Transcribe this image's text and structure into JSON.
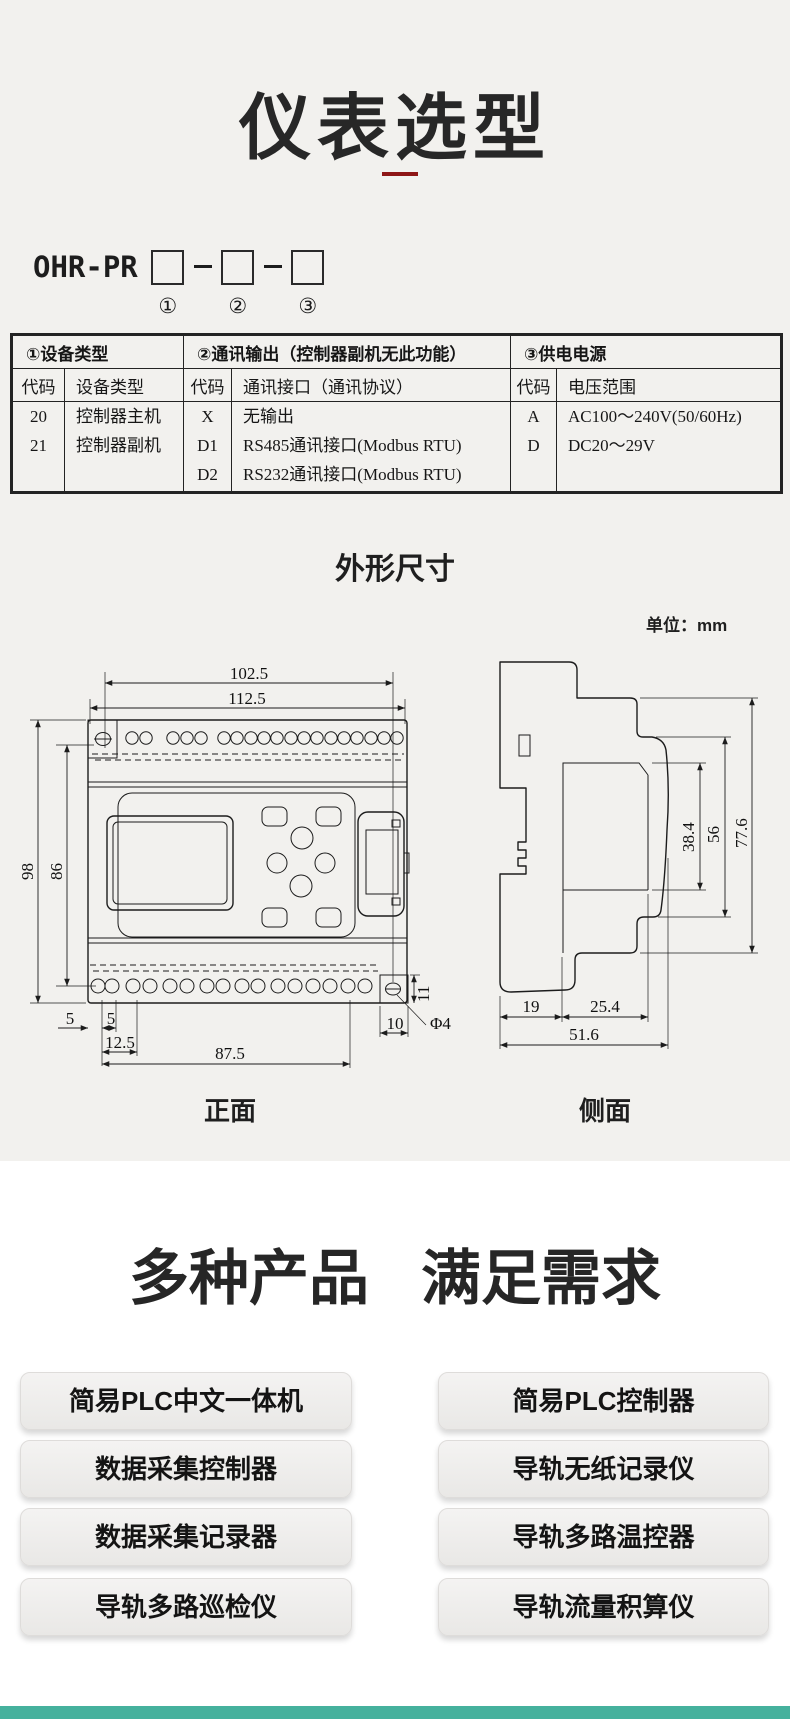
{
  "page": {
    "bg_top": "#f2f1ee",
    "bg_bottom": "#ffffff",
    "accent_red": "#8e1616",
    "footer_teal": "#45b19d"
  },
  "header": {
    "title": "仪表选型"
  },
  "model_code": {
    "prefix": "OHR-PR",
    "positions": [
      "①",
      "②",
      "③"
    ]
  },
  "selection_table": {
    "group_headers": [
      "①设备类型",
      "②通讯输出（控制器副机无此功能）",
      "③供电电源"
    ],
    "column_headers": [
      "代码",
      "设备类型",
      "代码",
      "通讯接口（通讯协议）",
      "代码",
      "电压范围"
    ],
    "device_rows": [
      [
        "20",
        "控制器主机"
      ],
      [
        "21",
        "控制器副机"
      ]
    ],
    "comm_rows": [
      [
        "X",
        "无输出"
      ],
      [
        "D1",
        "RS485通讯接口(Modbus RTU)"
      ],
      [
        "D2",
        "RS232通讯接口(Modbus RTU)"
      ]
    ],
    "power_rows": [
      [
        "A",
        "AC100～240V(50/60Hz)"
      ],
      [
        "D",
        "DC20～29V"
      ]
    ]
  },
  "dimensions": {
    "heading": "外形尺寸",
    "unit": "单位：mm",
    "front": {
      "label": "正面",
      "top_width_inner": "102.5",
      "top_width_outer": "112.5",
      "height_outer": "98",
      "height_inner": "86",
      "d5a": "5",
      "d5b": "5",
      "d12_5": "12.5",
      "d87_5": "87.5",
      "d10": "10",
      "d11": "11",
      "hole": "Φ4"
    },
    "side": {
      "label": "侧面",
      "d38_4": "38.4",
      "d56": "56",
      "d77_6": "77.6",
      "d19": "19",
      "d25_4": "25.4",
      "d51_6": "51.6"
    }
  },
  "products": {
    "heading": [
      "多种产品",
      "满足需求"
    ],
    "left": [
      "简易PLC中文一体机",
      "数据采集控制器",
      "数据采集记录器",
      "导轨多路巡检仪"
    ],
    "right": [
      "简易PLC控制器",
      "导轨无纸记录仪",
      "导轨多路温控器",
      "导轨流量积算仪"
    ]
  }
}
